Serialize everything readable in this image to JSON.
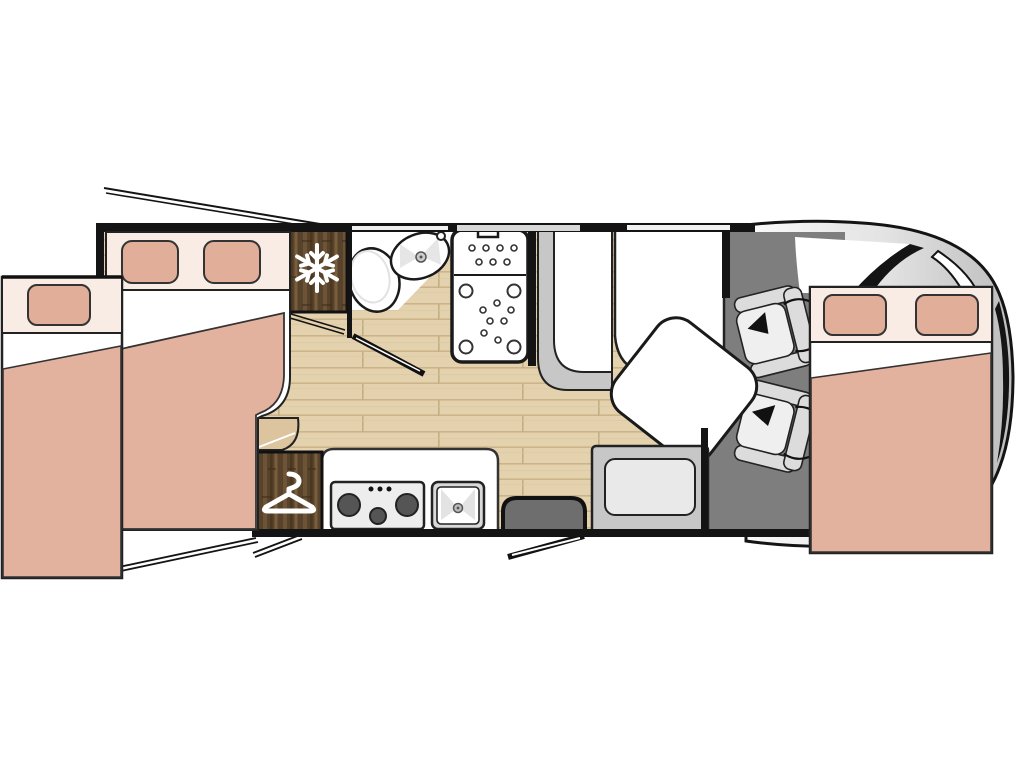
{
  "colors": {
    "wall": "#141414",
    "outline": "#1f1f1f",
    "bed_blanket": "#E3B29E",
    "bed_linen": "#F8ECE5",
    "pillow": "#E1AE9A",
    "floor_wood": "#E4D1AE",
    "floor_plank_line": "#CBB489",
    "cabinet_wood": "#57422C",
    "cabinet_wood_light": "#6E5436",
    "carpet": "#7E7E7E",
    "seat_light": "#DCDCDC",
    "seat_cushion": "#EFEFEF",
    "bench_frame": "#C7C7C7",
    "step_dark": "#6E6E6E",
    "cab_body_light": "#FAFAFA",
    "cab_body_shade": "#BDBDBD",
    "icon_white": "#FFFFFF"
  },
  "icons": {
    "fridge": "snowflake-icon",
    "wardrobe": "hanger-icon",
    "cab_seats": "swivel-arrow-icon"
  },
  "areas": {
    "rear_slideout_bed": "single-slide-out-bed",
    "rear_bed": "rear-double-bed",
    "fridge": "refrigerator",
    "bathroom": "washroom-toilet-basin",
    "shower": "shower-cubicle",
    "wardrobe": "wardrobe",
    "kitchen": "kitchen-hob-sink",
    "dinette": "dinette-table-benches",
    "entry": "entry-step-door",
    "cab": "driver-cab-two-swivel-seats",
    "overcab_bed": "overcab-double-bed"
  }
}
